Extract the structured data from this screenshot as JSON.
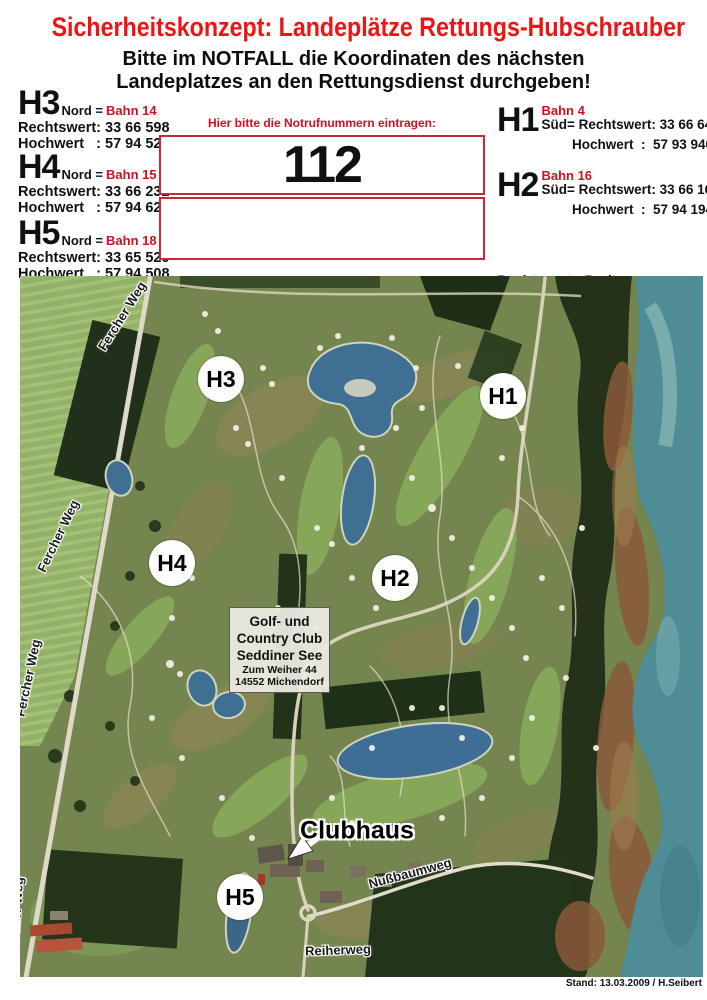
{
  "header": {
    "title": "Sicherheitskonzept: Landeplätze Rettungs-Hubschrauber",
    "subtitle_line1": "Bitte im NOTFALL die Koordinaten des nächsten",
    "subtitle_line2": "Landeplatzes an den Rettungsdienst durchgeben!"
  },
  "sites_left": [
    {
      "id": "H3",
      "dir": "Nord =",
      "bahn": "Bahn 14",
      "rechtswert": "Rechtswert: 33 66 598",
      "hochwert": "Hochwert   : 57 94 523"
    },
    {
      "id": "H4",
      "dir": "Nord =",
      "bahn": "Bahn 15",
      "rechtswert": "Rechtswert: 33 66 232",
      "hochwert": "Hochwert   : 57 94 621"
    },
    {
      "id": "H5",
      "dir": "Nord =",
      "bahn": "Bahn 18",
      "rechtswert": "Rechtswert: 33 65 520",
      "hochwert": "Hochwert   : 57 94 508"
    }
  ],
  "sites_right": [
    {
      "id": "H1",
      "bahn": "Bahn 4",
      "sued": "Süd= Rechtswert: 33 66 646",
      "hochwert": "Hochwert  :  57 93 940"
    },
    {
      "id": "H2",
      "bahn": "Bahn 16",
      "sued": "Süd= Rechtswert: 33 66 163",
      "hochwert": "Hochwert  :  57 94 194"
    }
  ],
  "legend": {
    "line1": "Rechtswert= Breite",
    "line2": "Hochwert   = Länge"
  },
  "emergency": {
    "instruction": "Hier bitte die Notrufnummern eintragen:",
    "number": "112"
  },
  "map": {
    "markers": [
      {
        "label": "H3"
      },
      {
        "label": "H1"
      },
      {
        "label": "H4"
      },
      {
        "label": "H2"
      },
      {
        "label": "H5"
      }
    ],
    "streets": {
      "fercher_weg": "Fercher Weg",
      "nussbaumweg": "Nußbaumweg",
      "reiherweg": "Reiherweg"
    },
    "club_box": {
      "line1": "Golf- und",
      "line2": "Country Club",
      "line3": "Seddiner See",
      "line4": "Zum Weiher 44",
      "line5": "14552 Michendorf"
    },
    "clubhaus_label": "Clubhaus"
  },
  "footer": {
    "stand_note": "Stand: 13.03.2009 / H.Seibert"
  },
  "colors": {
    "title_red": "#ee1414",
    "form_red": "#c22b36",
    "text_black": "#111111",
    "lake_teal": "#4e8c96",
    "forest_green": "#243219",
    "pond_blue": "#3f6f92"
  }
}
